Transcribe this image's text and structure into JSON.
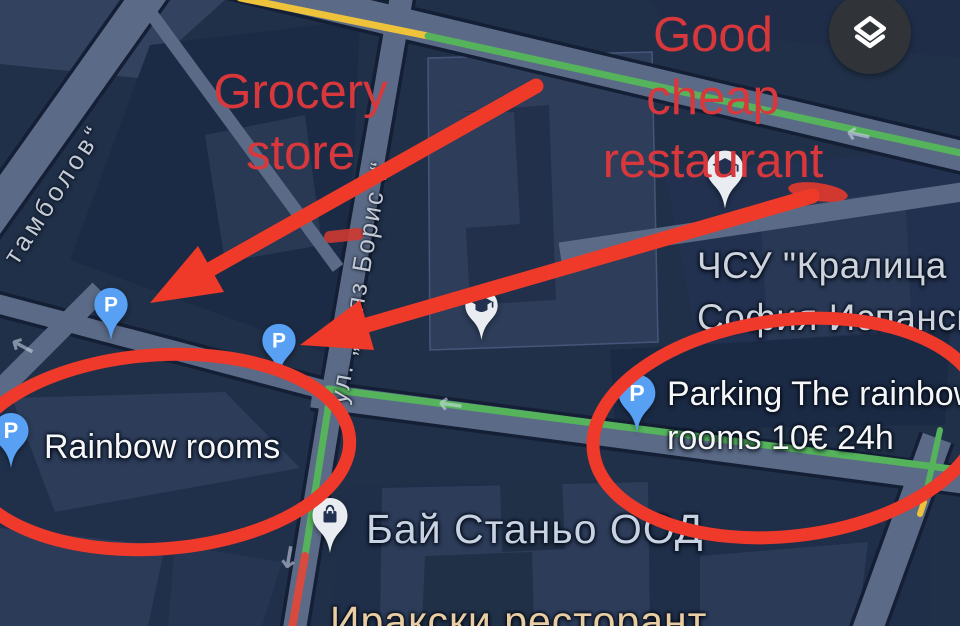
{
  "app": {
    "name": "maps-dark-mode-screenshot"
  },
  "controls": {
    "layers_button": {
      "icon": "layers-icon"
    }
  },
  "streets": {
    "stambolov": "тамболов“",
    "knyaz_boris": "ул. „Княз Борис I“"
  },
  "pois": {
    "school": {
      "line1": "ЧСУ \"Кралица",
      "line2": "София Испанска"
    },
    "parking_rainbow": {
      "line1": "Parking The rainbow",
      "line2": "rooms 10€ 24h"
    },
    "rainbow_rooms": "Rainbow rooms",
    "bay_stanyo": "Бай Станьо ООД",
    "iraqi_restaurant": "Иракски ресторант"
  },
  "pins": {
    "parking_glyph": "P",
    "school_icon": "graduation-cap-icon",
    "shop_icon": "shopping-bag-icon"
  },
  "annotations": {
    "grocery": {
      "line1": "Grocery",
      "line2": "store"
    },
    "restaurant": {
      "line1": "Good",
      "line2": "cheap",
      "line3": "restaurant"
    },
    "ink_color": "#ef3a2a",
    "text_color": "#d8383b"
  },
  "colors": {
    "map_background": "#203048",
    "road": "#5b6b87",
    "building": "#2c3c59",
    "traffic_green": "#55b35c",
    "traffic_yellow": "#eec33b",
    "traffic_red": "#d84a3e",
    "pin_blue": "#57a0f3",
    "label_white": "#f4f6f8",
    "label_orange": "#e9cda3",
    "label_blue": "#c7d2e2"
  }
}
